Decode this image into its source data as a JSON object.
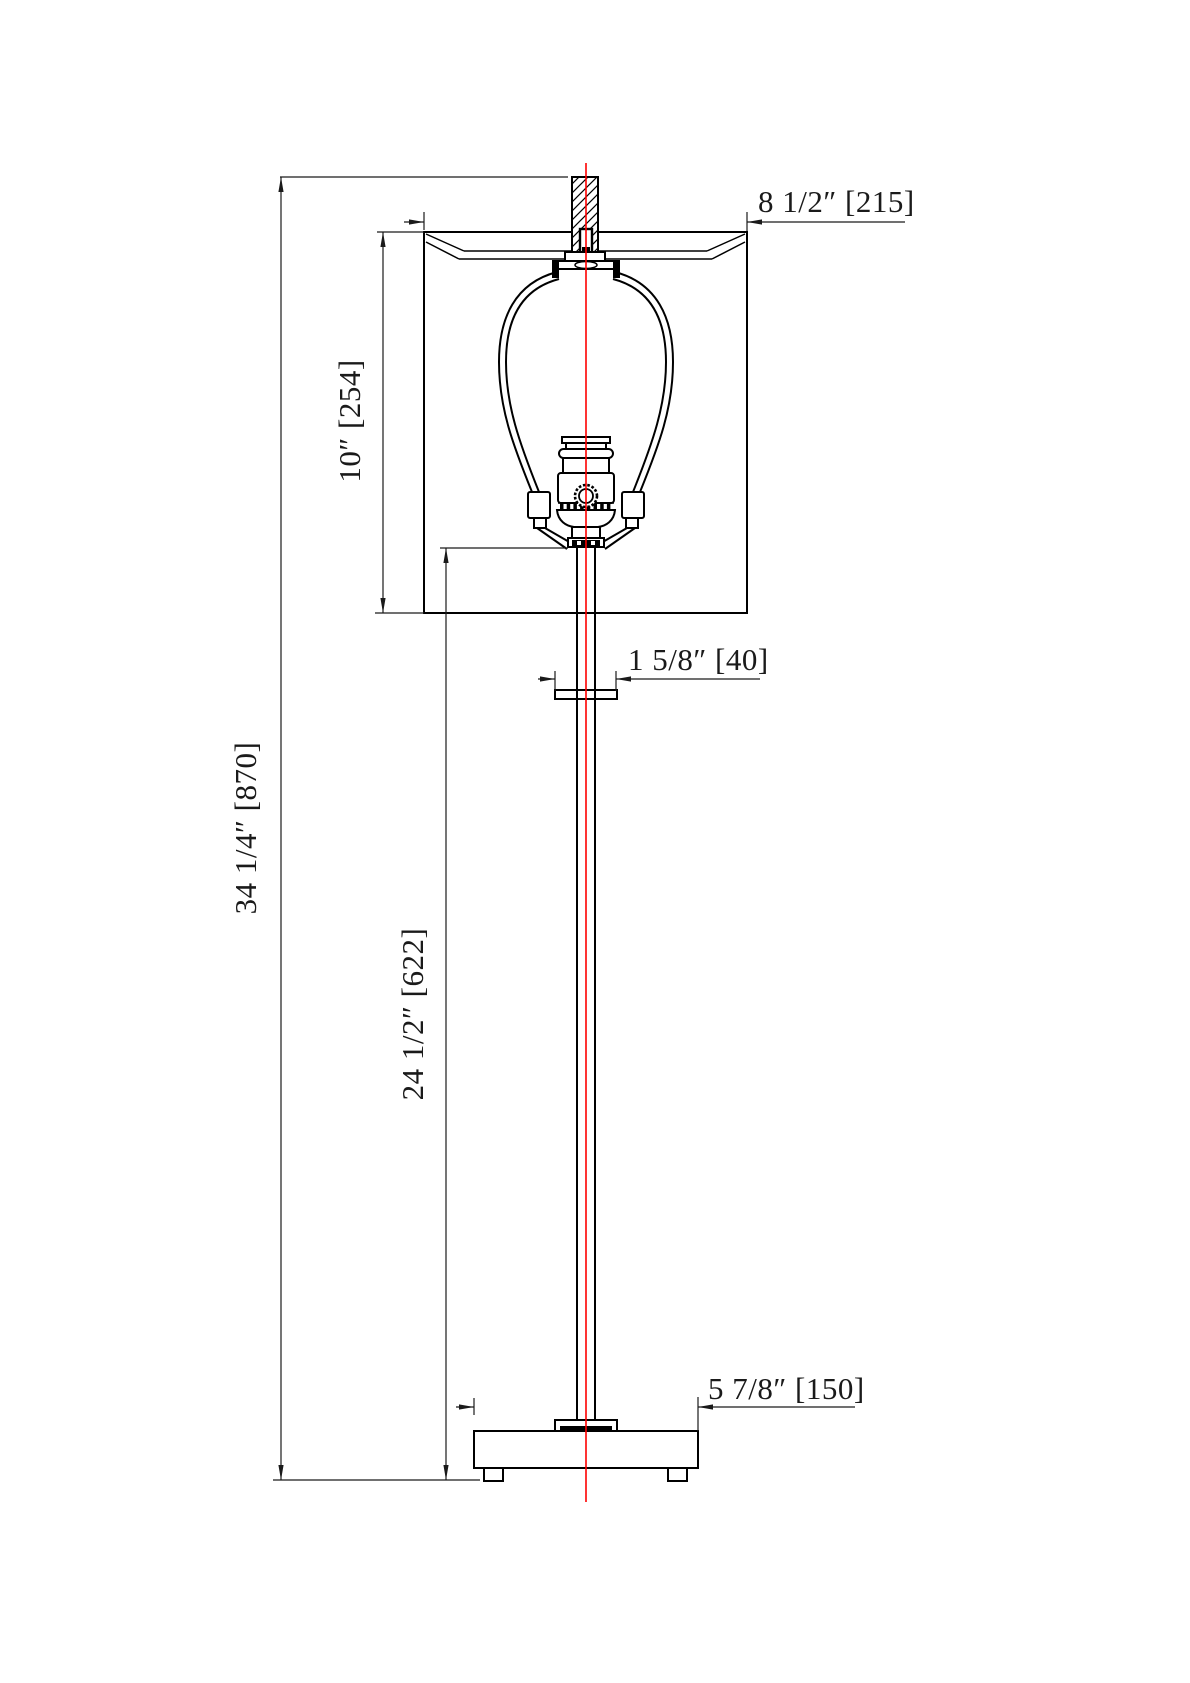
{
  "drawing": {
    "type": "technical-dimension-elevation",
    "subject": "table lamp with drum shade, harp, socket, column and plinth base",
    "units": "inches [mm]",
    "line_color": "#000000",
    "centerline_color": "#fe0000",
    "background_color": "#ffffff"
  },
  "dimensions": {
    "overall_height": {
      "text": "34 1/4″ [870]",
      "inches": "34 1/4\"",
      "mm": 870,
      "orientation": "vertical",
      "measures": "overall lamp height"
    },
    "shade_height": {
      "text": "10″ [254]",
      "inches": "10\"",
      "mm": 254,
      "orientation": "vertical",
      "measures": "shade height"
    },
    "shade_width": {
      "text": "8 1/2″ [215]",
      "inches": "8 1/2\"",
      "mm": 215,
      "orientation": "horizontal",
      "measures": "shade width"
    },
    "column_height": {
      "text": "24 1/2″ [622]",
      "inches": "24 1/2\"",
      "mm": 622,
      "orientation": "vertical",
      "measures": "column height from socket base to floor"
    },
    "collar_width": {
      "text": "1 5/8″ [40]",
      "inches": "1 5/8\"",
      "mm": 40,
      "orientation": "horizontal",
      "measures": "column collar width"
    },
    "base_width": {
      "text": "5 7/8″ [150]",
      "inches": "5 7/8\"",
      "mm": 150,
      "orientation": "horizontal",
      "measures": "base width"
    }
  }
}
